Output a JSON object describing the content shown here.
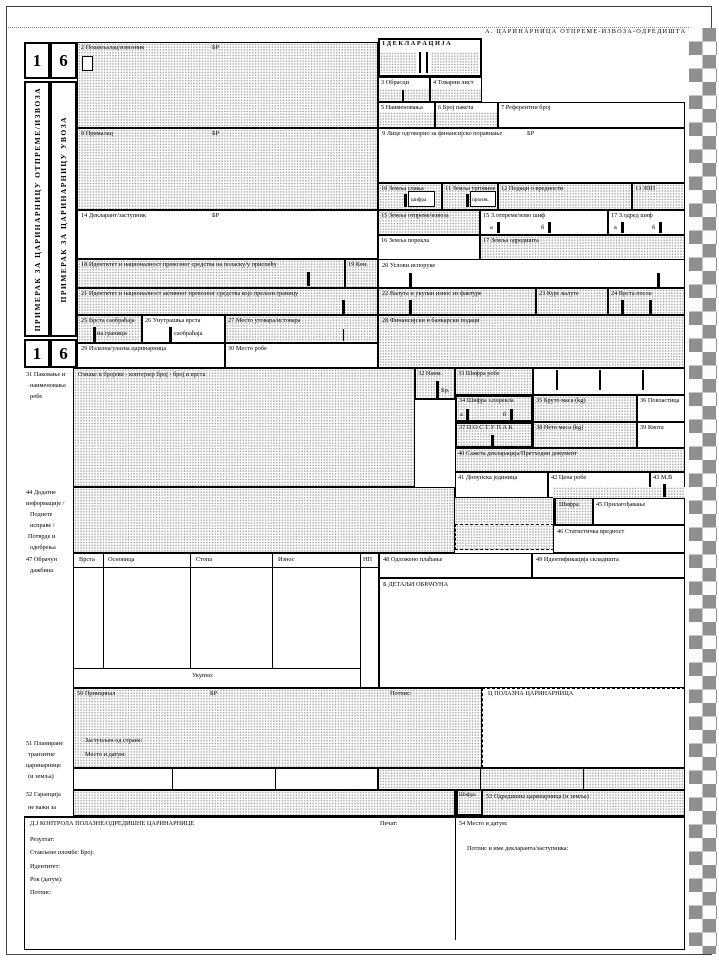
{
  "form": {
    "header_a": "А. ЦАРИНАРНИЦА ОТПРЕМЕ-ИЗВОЗА-ОДРЕДИШТА",
    "copies": {
      "num1": "1",
      "num6": "6",
      "label1": "ПРИМЕРАК ЗА ЦАРИНАРНИЦУ ОТПРЕМЕ/ИЗВОЗА",
      "label6": "ПРИМЕРАК ЗА ЦАРИНАРНИЦУ УВОЗА"
    },
    "b1": {
      "title": "1 Д Е К Л А Р А Ц И Ј А"
    },
    "b2": {
      "label": "2 Пошиљалац/извозник",
      "br": "БР"
    },
    "b3": {
      "label": "3 Обрасци"
    },
    "b4": {
      "label": "4 Товарни лист"
    },
    "b5": {
      "label": "5 Наименовања"
    },
    "b6": {
      "label": "6 Број пакета"
    },
    "b7": {
      "label": "7 Референтни број"
    },
    "b8": {
      "label": "8 Прималац",
      "br": "БР"
    },
    "b9": {
      "label": "9 Лице одговорно за финансијско поравнање",
      "br": "БР"
    },
    "b10": {
      "label": "10 Земља слања",
      "sub": "шифра"
    },
    "b11": {
      "label": "11 Земља трговине",
      "sub": "произв."
    },
    "b12": {
      "label": "12 Подаци о вредности"
    },
    "b13": {
      "label": "13 ЗПП"
    },
    "b14": {
      "label": "14 Декларант/заступник",
      "br": "БР"
    },
    "b15": {
      "label": "15 Земља отпреме/извоза"
    },
    "b15a": {
      "label": "15 З.отпреме/изво шиф",
      "a": "а",
      "b": "б"
    },
    "b17a": {
      "label": "17 З.одред шиф",
      "a": "а",
      "b": "б"
    },
    "b16": {
      "label": "16 Земља порекла"
    },
    "b17": {
      "label": "17 Земља одредишта"
    },
    "b18": {
      "label": "18 Идентитет и националност превозног средства на поласку/у приспећу"
    },
    "b19": {
      "label": "19 Кон."
    },
    "b20": {
      "label": "20 Услови испоруке"
    },
    "b21": {
      "label": "21 Идентитет и националност активног превозног средства које прелази границу"
    },
    "b22": {
      "label": "22 Валута и укупан износ из фактуре"
    },
    "b23": {
      "label": "23 Курс валуте"
    },
    "b24": {
      "label": "24 Врста посла"
    },
    "b25": {
      "label": "25 Врста саобраћаја",
      "sub": "на граници"
    },
    "b26": {
      "label": "26 Унутрашња врста",
      "sub": "саобраћаја"
    },
    "b27": {
      "label": "27 Место утовара/истовара"
    },
    "b28": {
      "label": "28 Финансијски и банкарски подаци"
    },
    "b29": {
      "label": "29 Излазна/улазна царинарница"
    },
    "b30": {
      "label": "30 Место робе"
    },
    "b31": {
      "label_lines": [
        "31 Паковање и",
        "наименовање",
        "робе"
      ],
      "inner": "Ознаке и бројеви - контејнер број - број и врста"
    },
    "b32": {
      "label": "32 Наим.",
      "sub": "Бр."
    },
    "b33": {
      "label": "33 Шифра робе"
    },
    "b34": {
      "label": "34 Шифра з.порекла",
      "a": "а",
      "b": "б"
    },
    "b35": {
      "label": "35 Бруто маса  (kg)"
    },
    "b36": {
      "label": "36 Повластица"
    },
    "b37": {
      "label": "37 П О С Т У П А К"
    },
    "b38": {
      "label": "38 Нето маса (kg)"
    },
    "b39": {
      "label": "39 Квота"
    },
    "b40": {
      "label": "40 Сажета декларација/Претходни документ"
    },
    "b41": {
      "label": "41 Допунска јединица"
    },
    "b42": {
      "label": "42 Цена робе"
    },
    "b43": {
      "label": "43 М.В"
    },
    "b44": {
      "label_lines": [
        "44 Додатне",
        "информације /",
        "Поднете",
        "исправе /",
        "Потврде и",
        "одобрења"
      ]
    },
    "b45": {
      "code": "Шифра",
      "label": "45 Прилагођавање"
    },
    "b46": {
      "label": "46 Статистичка вредност"
    },
    "b47": {
      "label_lines": [
        "47 Обрачун",
        "дажбина"
      ],
      "col_type": "Врста",
      "col_base": "Основица",
      "col_rate": "Стопа",
      "col_amount": "Износ",
      "col_mp": "НП",
      "total": "Укупно:"
    },
    "b48": {
      "label": "48 Одложено плаћање"
    },
    "b49": {
      "label": "49 Идентификација складишта"
    },
    "bB": {
      "label": "Б  ДЕТАЉИ ОБРАЧУНА"
    },
    "b50": {
      "label": "50 Принципал",
      "br": "БР",
      "signature": "Потпис:",
      "represented": "Заступљен од стране:",
      "place_date": "Место и датум:"
    },
    "b51": {
      "label_lines": [
        "51 Планиране",
        "транзитне",
        "царинарнице",
        "(и земља)"
      ]
    },
    "b52": {
      "label_lines": [
        "52 Гаранција",
        "не важи за"
      ],
      "code": "Шифра"
    },
    "b53": {
      "label": "53 Одредишна царинарница (и земља)"
    },
    "bC": {
      "label": "Ц  ПОЛАЗНА ЦАРИНАРНИЦА"
    },
    "bD": {
      "title": "Д.Ј   КОНТРОЛА ПОЛАЗНЕ/ОДРЕДИШНЕ ЦАРИНАРНИЦЕ",
      "seal": "Печат:",
      "b54": "54 Место и датум:",
      "result": "Резултат:",
      "seals": "Стављене пломбе:  Број:",
      "identity": "Идентитет:",
      "deadline": "Рок (датум):",
      "signature": "Потпис:",
      "declarant_sig": "Потпис и име декларанта/заступника:"
    }
  }
}
